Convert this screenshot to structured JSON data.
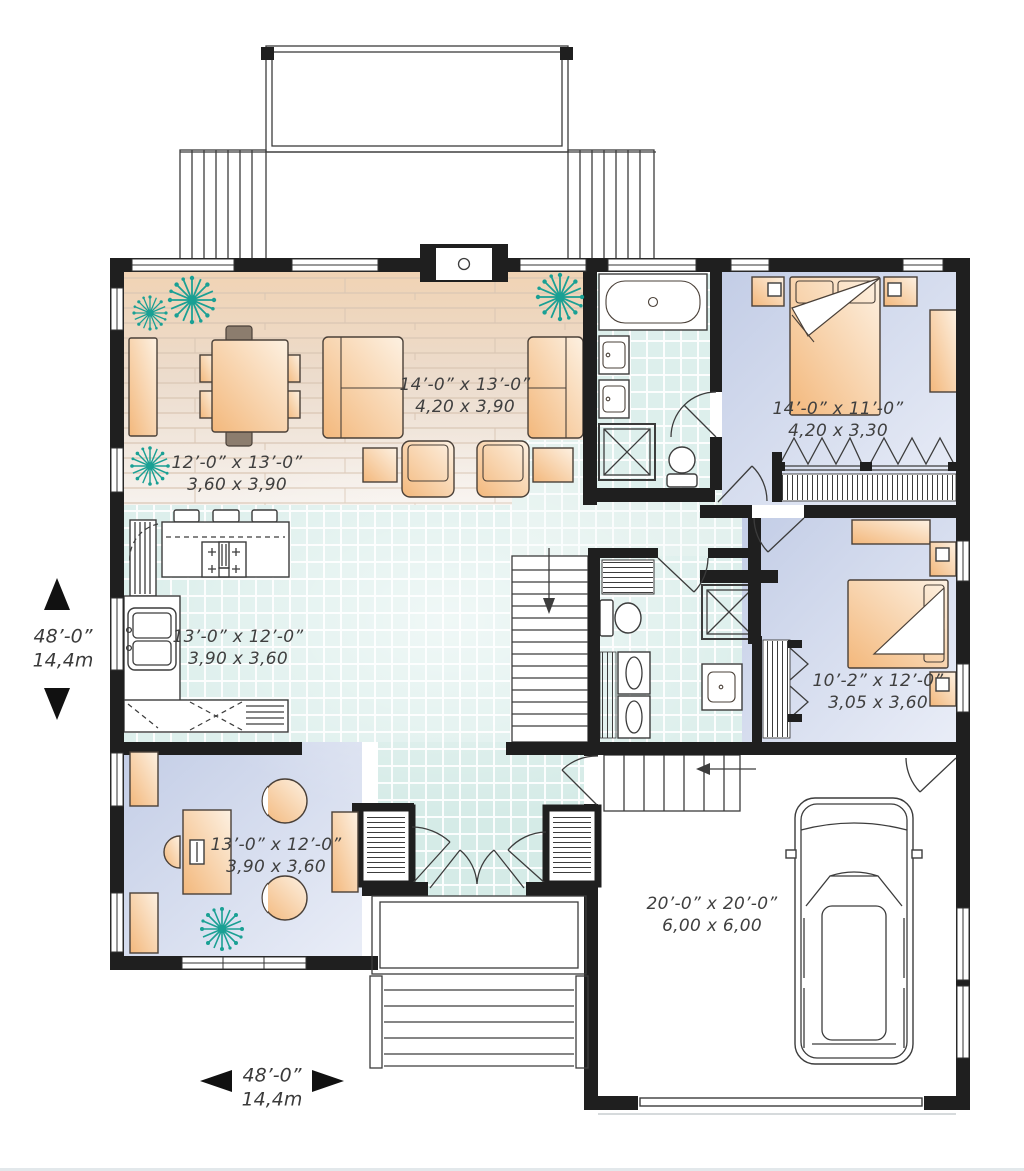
{
  "plan": {
    "type": "residential-floor-plan",
    "colors": {
      "wall": "#1f1f1f",
      "wood_floor": "#eedcc8",
      "tile_floor": "#dff0ec",
      "carpet_floor": "#cbd4e9",
      "furniture": "#f6c288",
      "plant": "#1aa094",
      "label_text": "#3f3f3f"
    },
    "rooms": [
      {
        "id": "living-room",
        "imperial": "14’-0” x 13’-0”",
        "metric": "4,20 x 3,90"
      },
      {
        "id": "dining-room",
        "imperial": "12’-0” x 13’-0”",
        "metric": "3,60 x 3,90"
      },
      {
        "id": "kitchen",
        "imperial": "13’-0” x 12’-0”",
        "metric": "3,90 x 3,60"
      },
      {
        "id": "master-bedroom",
        "imperial": "14’-0” x 11’-0”",
        "metric": "4,20 x 3,30"
      },
      {
        "id": "bedroom-2",
        "imperial": "10’-2” x 12’-0”",
        "metric": "3,05 x 3,60"
      },
      {
        "id": "office",
        "imperial": "13’-0” x 12’-0”",
        "metric": "3,90 x 3,60"
      },
      {
        "id": "garage",
        "imperial": "20’-0” x 20’-0”",
        "metric": "6,00 x 6,00"
      }
    ],
    "overall_dimensions": {
      "depth": {
        "imperial": "48’-0”",
        "metric": "14,4m"
      },
      "width": {
        "imperial": "48’-0”",
        "metric": "14,4m"
      }
    }
  }
}
